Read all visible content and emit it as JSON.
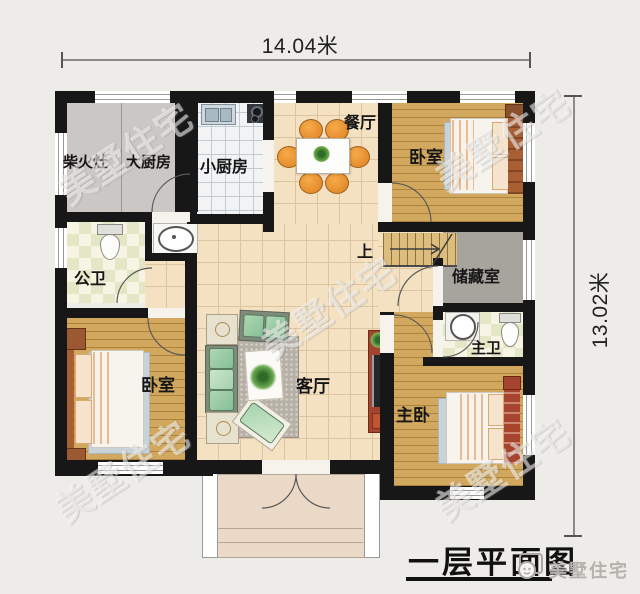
{
  "dimensions": {
    "width_label": "14.04米",
    "height_label": "13.02米"
  },
  "rooms": {
    "firewood_stove": "柴火灶",
    "big_kitchen": "大厨房",
    "small_kitchen": "小厨房",
    "dining_room": "餐厅",
    "bedroom_top_right": "卧室",
    "public_bathroom": "公卫",
    "storage_room": "储藏室",
    "stairs_up": "上",
    "living_room": "客厅",
    "bedroom_bottom_left": "卧室",
    "master_bathroom": "主卫",
    "master_bedroom": "主卧"
  },
  "title": {
    "text": "一层平面图"
  },
  "brand": {
    "name": "美墅住宅"
  },
  "watermark": {
    "text": "美墅住宅"
  },
  "colors": {
    "page_bg": "#eeece8",
    "wall": "#171717",
    "wood_floor": "#d2a85e",
    "tile_cream": "#f3e1c2",
    "kitchen_gray": "#cbc7c5",
    "bath_checker_green": "#e3e7c6",
    "storage_gray": "#a7a39d",
    "chair_orange": "#dd7f1f",
    "sofa_green": "#85bf97",
    "accent_red": "#a2442e"
  }
}
